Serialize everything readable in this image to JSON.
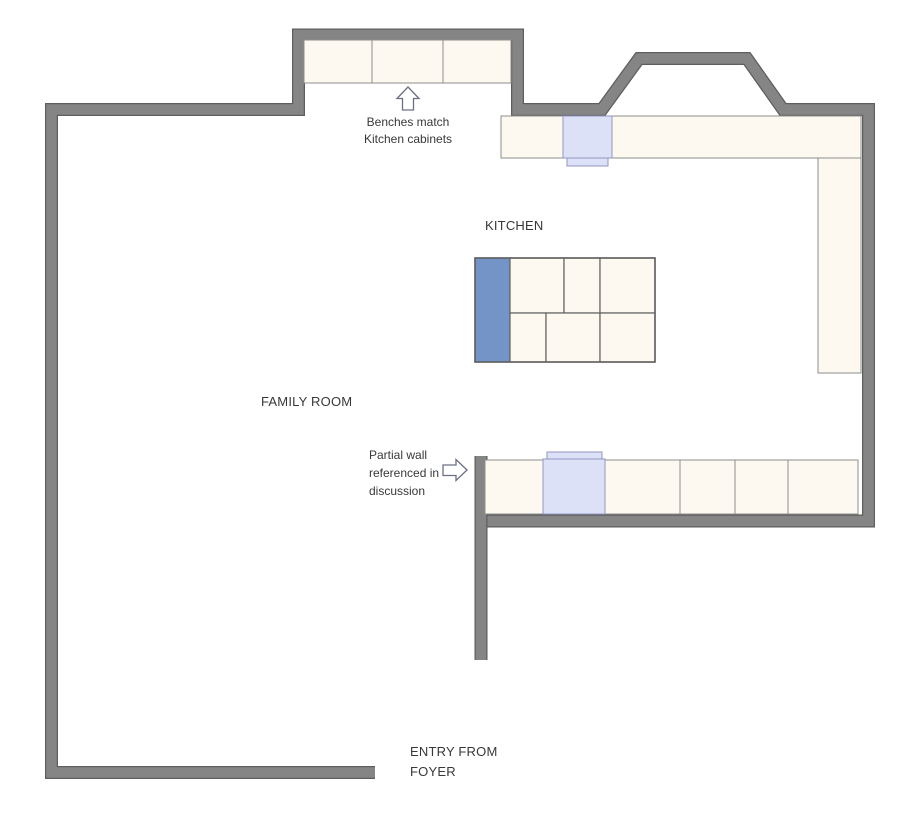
{
  "labels": {
    "kitchen": "KITCHEN",
    "family_room": "FAMILY ROOM",
    "entry_line1": "ENTRY FROM",
    "entry_line2": "FOYER"
  },
  "annotations": {
    "benches": {
      "line1": "Benches match",
      "line2": "Kitchen cabinets"
    },
    "partial_wall": {
      "line1": "Partial wall",
      "line2": "referenced in",
      "line3": "discussion"
    }
  },
  "icons": {
    "benches_pointer": "up-block-arrow",
    "partial_wall_pointer": "right-block-arrow"
  },
  "colors": {
    "background": "#FFFFFF",
    "wall_fill": "#858585",
    "wall_outline": "#5E5E5E",
    "cabinet_fill": "#FEF9F0",
    "cabinet_stroke": "#8E8E8E",
    "island_stroke": "#616161",
    "island_accent_blue": "#7494C7",
    "appliance_fill": "#DDE1F8",
    "appliance_stroke": "#9196C2",
    "arrow_stroke": "#6B7083",
    "text": "#383838"
  }
}
